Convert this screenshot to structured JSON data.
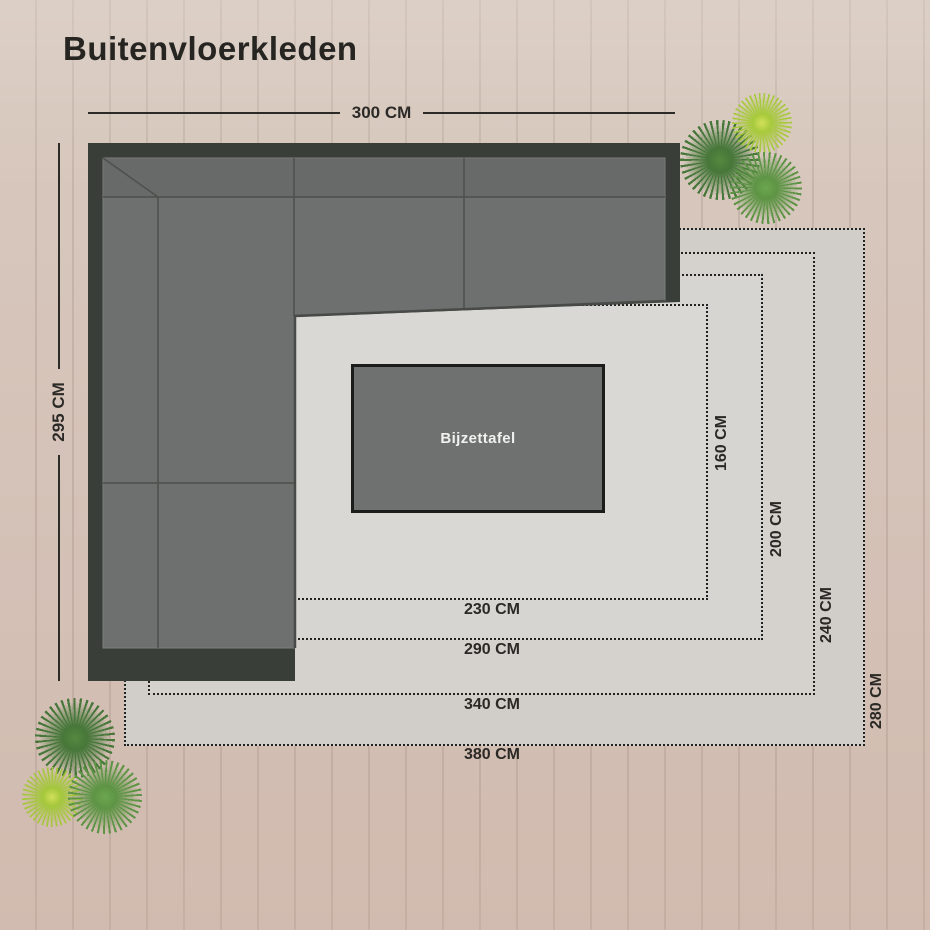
{
  "title": "Buitenvloerkleden",
  "scene": {
    "sofa": {
      "width_label": "300 CM",
      "height_label": "295 CM"
    },
    "side_table": {
      "label": "Bijzettafel"
    },
    "rugs": [
      {
        "id": "rug-230x160",
        "width_label": "230 CM",
        "height_label": "160 CM"
      },
      {
        "id": "rug-290x200",
        "width_label": "290 CM",
        "height_label": "200 CM"
      },
      {
        "id": "rug-340x240",
        "width_label": "340 CM",
        "height_label": "240 CM"
      },
      {
        "id": "rug-380x280",
        "width_label": "380 CM",
        "height_label": "280 CM"
      }
    ]
  },
  "colors": {
    "deck_wood": "#d5c3b9",
    "rug_light_gray": "#d7d5d2",
    "sofa_frame": "#3a3e39",
    "sofa_cushion": "#6d706e",
    "table_gray": "#6f7170",
    "label_text": "#2a2925",
    "plant_dark_green": "#47773a",
    "plant_mid_green": "#5e9445",
    "plant_bright_green": "#a7c93c"
  }
}
